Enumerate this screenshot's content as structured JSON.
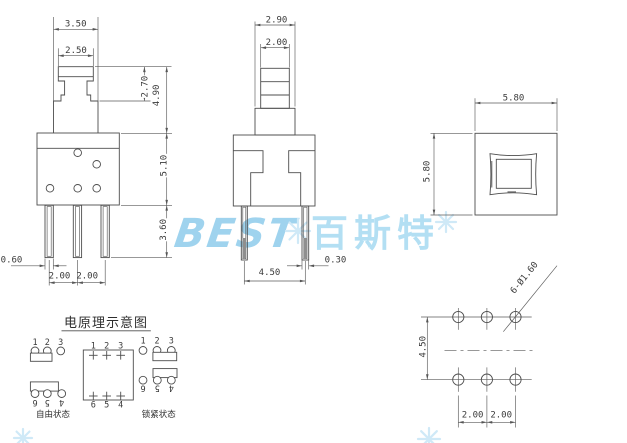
{
  "page": {
    "background": "#ffffff",
    "line_color": "#4d4d4d",
    "watermark_color": "#9fd3ee"
  },
  "watermark": {
    "logo": "BEST",
    "brand_cn": "百斯特"
  },
  "front_view": {
    "cap_width": "3.50",
    "cap_top_width": "2.50",
    "plunger_height": "2.70",
    "total_plunger_height": "4.90",
    "body_height": "5.10",
    "pin_length": "3.60",
    "pin_width": "0.60",
    "pin_pitch_left": "2.00",
    "pin_pitch_right": "2.00"
  },
  "side_view": {
    "base_width": "2.90",
    "stem_width": "2.00",
    "pin_span": "4.50",
    "pin_thickness": "0.30"
  },
  "top_view": {
    "width": "5.80",
    "height": "5.80"
  },
  "bottom_view": {
    "row_spacing": "4.50",
    "hole_pitch_left": "2.00",
    "hole_pitch_right": "2.00",
    "hole_callout": "6-Ø1.60"
  },
  "schematic": {
    "title": "电原理示意图",
    "free_state_label": "自由状态",
    "locked_state_label": "锁紧状态",
    "pins_top": [
      "1",
      "2",
      "3"
    ],
    "pins_bottom": [
      "6",
      "5",
      "4"
    ]
  }
}
